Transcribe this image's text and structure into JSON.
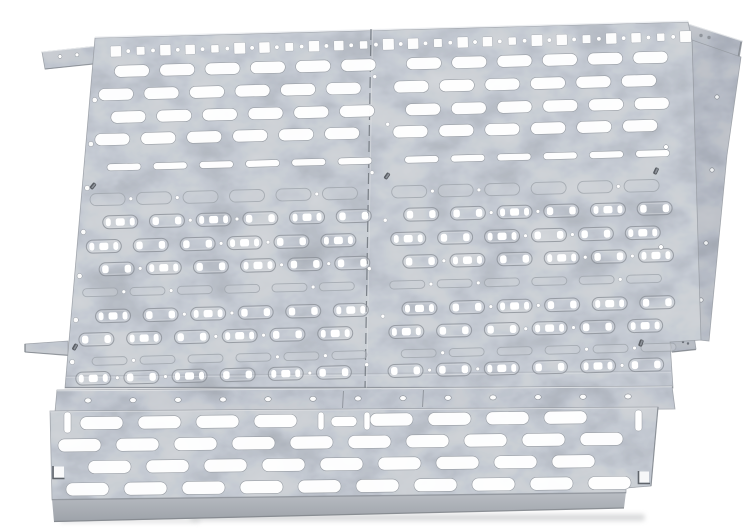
{
  "image": {
    "kind": "product-photo",
    "subject": "Galvanized steel perforated mounting plate made of two joined panels with knockout slots, corner tabs and a slotted bottom ventilation rail",
    "background": "#ffffff",
    "width": 750,
    "height": 531
  },
  "palette": {
    "background": "#ffffff",
    "metal_face": "#c8ccd1",
    "metal_strip": "#c3c7cd",
    "metal_rail": "#c7cbd0",
    "metal_flange": "#b7bbc2",
    "metal_tab": "#c2c6cc",
    "fold_top": "#b9bdc3",
    "fold_bottom": "#9da2a9",
    "edge_line": "#9ba0a7",
    "edge_dark": "#7f848b",
    "seam": "#6f747b",
    "highlight": "#eceef1",
    "hole_white": "#ffffff",
    "knockout_stroke": "#8b9097",
    "knockout_inner": "#dde0e4",
    "flush_fill": "#cbd0d6",
    "flush_stroke": "#a3a9b0",
    "hole_rim": "#8e939a",
    "stud": "#595d63",
    "shadow": "#bdbfc1"
  },
  "main_plate": {
    "name": "main mounting plate",
    "panel_count": 2,
    "top_edge_row": {
      "squares": 24,
      "dots": 23,
      "pitch": 24.7,
      "start_u": 22,
      "square_sizes": [
        11,
        8.5,
        11,
        10,
        8,
        11.5
      ],
      "dot_radius": 2.2,
      "v": 14
    },
    "slot_grid": {
      "slot_width": 35,
      "pitch": 45,
      "slots_per_half": 6,
      "half_starts": {
        "left_even": 22,
        "left_odd": 8,
        "right_even": 312,
        "right_odd": 300
      },
      "rows": [
        {
          "v": 34,
          "type": "open"
        },
        {
          "v": 57,
          "type": "open"
        },
        {
          "v": 80,
          "type": "open"
        },
        {
          "v": 102,
          "type": "open"
        },
        {
          "v": 130,
          "type": "thin-open"
        },
        {
          "v": 162,
          "type": "flush"
        },
        {
          "v": 185,
          "type": "knockout"
        },
        {
          "v": 209,
          "type": "knockout"
        },
        {
          "v": 232,
          "type": "knockout"
        },
        {
          "v": 255,
          "type": "flush-thin"
        },
        {
          "v": 279,
          "type": "knockout"
        },
        {
          "v": 302,
          "type": "knockout"
        },
        {
          "v": 324,
          "type": "flush-thin"
        },
        {
          "v": 341,
          "type": "knockout"
        }
      ]
    },
    "left_edge_hole_ys": [
      100,
      144,
      188,
      232,
      276,
      320,
      362
    ],
    "right_face_dots": [
      [
        666,
        147
      ],
      [
        661,
        247
      ]
    ],
    "flange_holes": [
      [
        717,
        97
      ],
      [
        712,
        170
      ],
      [
        706,
        243
      ],
      [
        701,
        300
      ]
    ],
    "seam_dot_columns": [
      281,
      295
    ],
    "studs": [
      [
        387,
        176,
        35
      ],
      [
        656,
        171,
        25
      ],
      [
        93,
        186,
        40
      ],
      [
        75,
        347,
        30
      ],
      [
        641,
        343,
        20
      ]
    ]
  },
  "bottom_rail": {
    "name": "slotted bottom rail",
    "strip_holes": 13,
    "strip_hole_start_x": 88,
    "strip_hole_pitch": 45,
    "slot": {
      "width": 43,
      "height": 13,
      "pitch": 58
    },
    "slot_rows": [
      {
        "y": 423.5,
        "start": 80,
        "count": 9,
        "skip_center": true
      },
      {
        "y": 445.5,
        "start": 58,
        "count": 10,
        "skip_center": false
      },
      {
        "y": 467.5,
        "start": 88,
        "count": 9,
        "skip_center": false
      },
      {
        "y": 489.5,
        "start": 66,
        "count": 10,
        "skip_center": false
      }
    ],
    "center_pattern": {
      "vertical_slots": [
        318,
        364
      ],
      "horizontal_slot_cx": 344
    },
    "end_vertical_slots": [
      [
        64,
        412
      ],
      [
        635,
        410
      ]
    ]
  },
  "tabs": {
    "top_left": "corner bracket tab",
    "top_right": "corner bracket tab",
    "left_side": "side mounting tab",
    "bottom_right": "notch foot"
  }
}
